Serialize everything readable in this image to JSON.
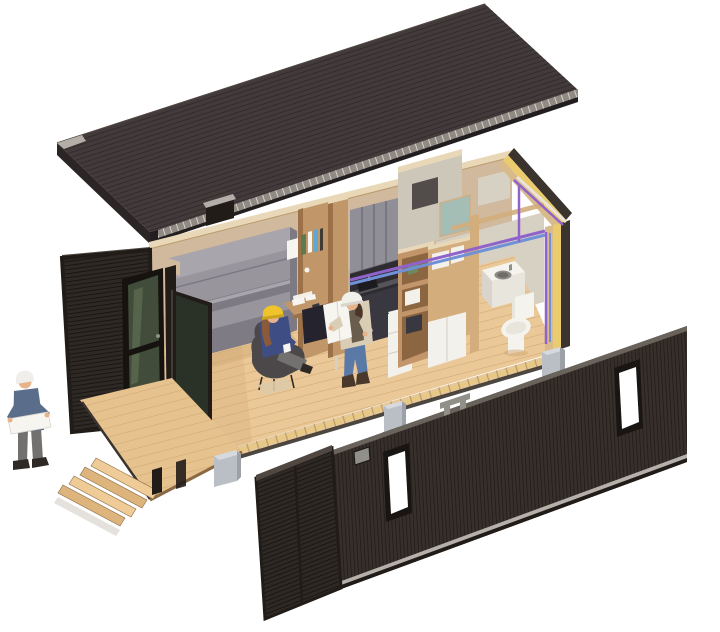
{
  "meta": {
    "title": "Exploded axonometric cutaway rendering of a shipping-container tiny home under construction"
  },
  "scene": {
    "view": "exploded axonometric 3D rendering",
    "background": "plain white",
    "components": [
      "corrugated dark metal roof panel lifted above the container",
      "container shell with louvered dark end wall and open glass entry door",
      "interior: folded grey murphy bed against timber back wall",
      "interior: built-in desk with shelf of books and pinned papers",
      "interior: grey kitchen upper cabinets, dark counter with sink, white fridge",
      "interior: open timber storage shelving",
      "bathroom: concrete walls, teal glazed panel, white basin counter and toilet",
      "purple and blue service pipes running along walls",
      "cutaway wall section showing yellow insulation layers",
      "timber floor deck with four wooden steps",
      "three concrete pad footings under the floor",
      "detached slatted facade panel with two windows, vent, lifting handle and louvered screen"
    ],
    "figures": [
      {
        "id": "architect-outside",
        "description": "white-haired man in blue shirt and grey trousers reviewing drawings beside the steps"
      },
      {
        "id": "worker-seated",
        "description": "worker with yellow hard hat seated in a dark lounge chair holding a mug"
      },
      {
        "id": "worker-standing",
        "description": "worker with white hard hat, tan jacket and jeans holding a large white plan sheet"
      }
    ]
  },
  "palette": {
    "bg": "#ffffff",
    "roof_top": "#423a3b",
    "roof_seam": "#2c2627",
    "roof_edge_dark": "#221d1e",
    "roof_side": "#2b2526",
    "eaves_strip": "#8f8a84",
    "eaves_tick": "#d6d0c6",
    "gutter_gray": "#b3aea8",
    "cladding_dark": "#2f2925",
    "cladding_frame": "#211c18",
    "louver_line": "#141110",
    "trim_warm": "#4f4740",
    "panel_base": "#362f2a",
    "panel_slat_line": "#211c19",
    "panel_trim": "#6a635b",
    "panel_bottom_rail": "#b5b1aa",
    "window_frame": "#191512",
    "window_glass": "#ffffff",
    "vent_gray": "#909089",
    "door_frame": "#15120f",
    "door_glass": "#414d3a",
    "door_glass_hi": "#5f6d52",
    "leaf_glass": "#2a3126",
    "wood_floor": "#eac898",
    "wood_plank": "#d0a874",
    "deck_wood": "#e6c28e",
    "deck_shadow": "#8a6a45",
    "step_top": "#eecb97",
    "step_face": "#dcb47c",
    "soft_shadow": "#d4cfc6",
    "wall_tan": "#d0b99d",
    "wall_tan_dark": "#c2a789",
    "wall_top_strip": "#e9d8b8",
    "wood_partition": "#c1976a",
    "wood_partition_dark": "#9c7148",
    "wood_frame": "#d3ad7c",
    "bed_gray": "#98959d",
    "bed_gray_light": "#a8a5ad",
    "bed_gray_dark": "#7d7a83",
    "bed_shadow": "#696670",
    "cab_gray": "#908f97",
    "cab_gap": "#6b6a72",
    "counter_dark": "#2e2c30",
    "counter_lip": "#56545b",
    "sink_dark": "#1c1b1f",
    "base_cab": "#393840",
    "white_goods": "#f3f1ec",
    "shelf_wood": "#c2956b",
    "shelf_shadow": "#8c6541",
    "plant_green": "#6b8b5a",
    "concrete_wall": "#cdc7ba",
    "niche_dark": "#524d4a",
    "teal_glass": "#a4bdb5",
    "bath_wall": "#d7d1c4",
    "fixture_white": "#f5f3ee",
    "fixture_mid": "#e8e5dc",
    "fixture_shadow": "#d9d5cc",
    "basin_dark": "#8d8983",
    "basin_inner": "#6f6b66",
    "insul_yellow": "#eacb6e",
    "section_tan": "#d9bb8b",
    "edge_dark": "#3a332e",
    "floor_edge": "#e6c897",
    "floor_edge_tick": "#bb9a6e",
    "pipe_purple": "#9062cc",
    "pipe_blue": "#7090d8",
    "conduit_white": "#eae4da",
    "concrete_block": "#babfc5",
    "concrete_block_top": "#d6dade",
    "concrete_block_side": "#9ba1a7",
    "hat_yellow": "#eec32b",
    "hat_yellow_dark": "#c9a31d",
    "hat_white": "#f2f0ea",
    "jacket_blue": "#3f4d85",
    "jacket_tan": "#d9cdb5",
    "vest_dark": "#55493c",
    "jeans_blue": "#5b79a6",
    "pants_gray": "#73716f",
    "shirt_blue": "#5a6e8c",
    "skin": "#e7b38b",
    "hair_brown": "#8a5a3a",
    "hair_dark": "#4a3628",
    "hair_white": "#f0eeea",
    "shoe_dark": "#2e2925",
    "boot_brown": "#4a382a",
    "chair_dark": "#4c484a",
    "mat_tan": "#ddcaa7",
    "paper_white": "#f7f5f0",
    "under_desk": "#25242e",
    "leg_light": "#d8d0c2",
    "book_green": "#5c7a50",
    "book_blue": "#5aa8d4",
    "book_dark": "#3e3a36"
  }
}
